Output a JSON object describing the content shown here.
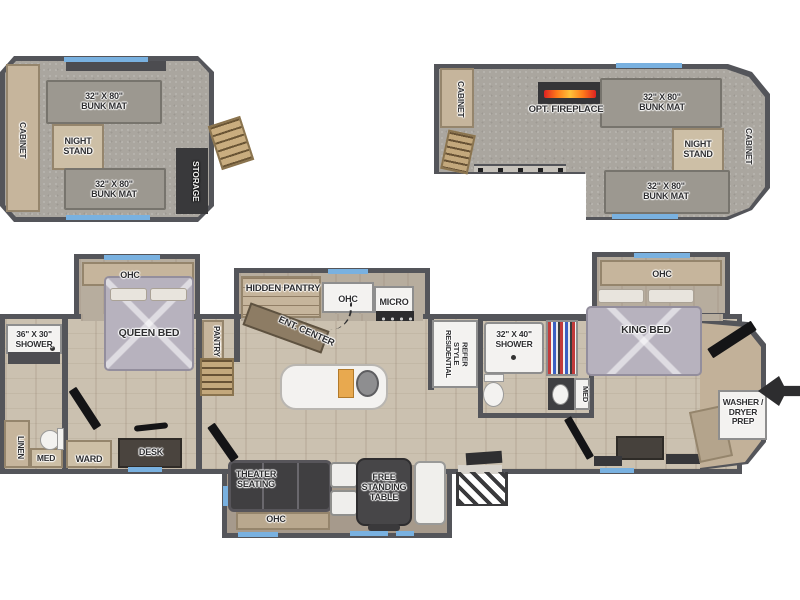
{
  "plan": {
    "rear_loft": {
      "cabinet": "CABINET",
      "top_bunk_l1": "32\" X 80\"",
      "top_bunk_l2": "BUNK MAT",
      "night_stand_l1": "NIGHT",
      "night_stand_l2": "STAND",
      "bottom_bunk_l1": "32\" X 80\"",
      "bottom_bunk_l2": "BUNK MAT",
      "storage": "STORAGE"
    },
    "front_loft": {
      "cabinet_left": "CABINET",
      "fireplace": "OPT. FIREPLACE",
      "top_bunk_l1": "32\" X 80\"",
      "top_bunk_l2": "BUNK MAT",
      "night_stand_l1": "NIGHT",
      "night_stand_l2": "STAND",
      "cabinet_right": "CABINET",
      "bottom_bunk_l1": "32\" X 80\"",
      "bottom_bunk_l2": "BUNK MAT"
    },
    "rear_bath": {
      "shower_l1": "36\" X 30\"",
      "shower_l2": "SHOWER",
      "linen": "LINEN",
      "med": "MED"
    },
    "queen_bedroom": {
      "ohc": "OHC",
      "bed": "QUEEN BED",
      "ward": "WARD",
      "desk": "DESK"
    },
    "hall": {
      "pantry": "PANTRY"
    },
    "kitchen": {
      "hidden_pantry": "HIDDEN PANTRY",
      "ohc": "OHC",
      "micro": "MICRO",
      "ent_center": "ENT. CENTER",
      "refer_l1": "RESIDENTIAL",
      "refer_l2": "STYLE",
      "refer_l3": "REFER"
    },
    "mid_bath": {
      "shower_l1": "32\" X 40\"",
      "shower_l2": "SHOWER",
      "med": "MED"
    },
    "king_bedroom": {
      "ohc": "OHC",
      "bed": "KING BED",
      "washer_l1": "WASHER /",
      "washer_l2": "DRYER",
      "washer_l3": "PREP"
    },
    "living_slide": {
      "theater_l1": "THEATER",
      "theater_l2": "SEATING",
      "table_l1": "FREE",
      "table_l2": "STANDING",
      "table_l3": "TABLE",
      "ohc": "OHC"
    },
    "colors": {
      "wall": "#54555a",
      "wood_floor": "#cbc1b0",
      "carpet": "#aaa69f",
      "cabinet_tan": "#c6b59c",
      "window_accent": "#79b1e0",
      "dark_furniture": "#3f3f42",
      "bed": "#b7b2be",
      "fireplace_flame": "#ff7a1a"
    }
  }
}
